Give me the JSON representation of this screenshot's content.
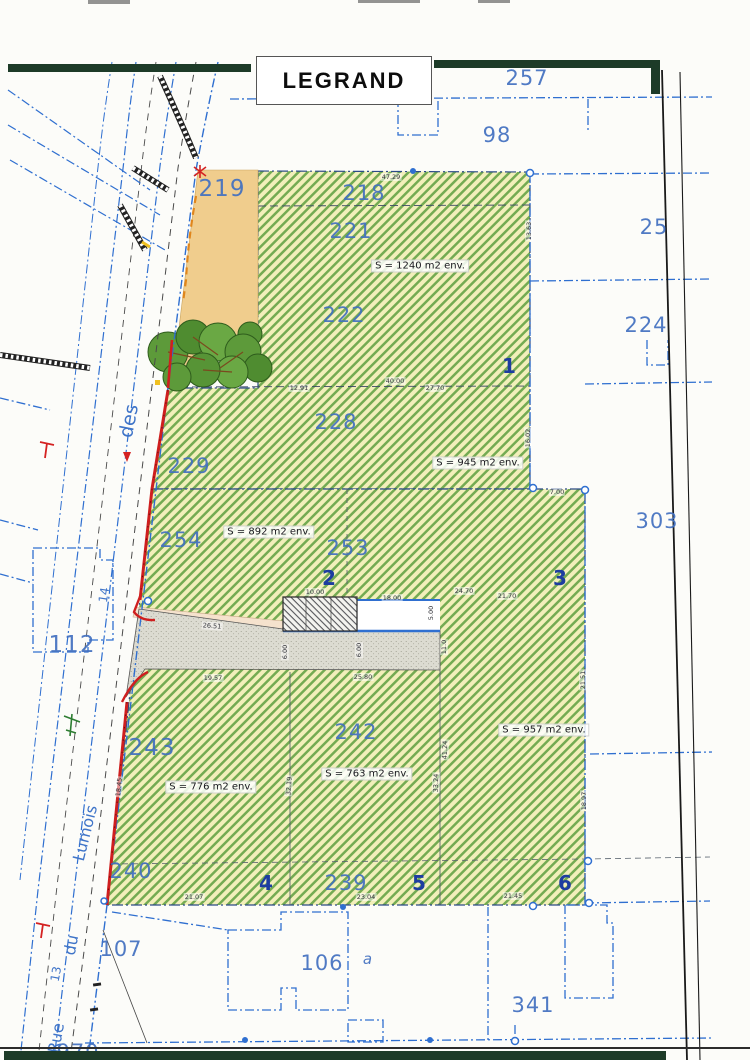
{
  "title": {
    "name": "LEGRAND"
  },
  "parcels": {
    "n257": "257",
    "n98": "98",
    "n219": "219",
    "n218": "218",
    "n221": "221",
    "n222": "222",
    "n25": "25",
    "n224": "224",
    "n228": "228",
    "n229": "229",
    "n254": "254",
    "n253": "253",
    "n303": "303",
    "n112": "112",
    "n243": "243",
    "n242": "242",
    "n240": "240",
    "n239": "239",
    "n107": "107",
    "n106": "106",
    "na": "a",
    "n341": "341",
    "n970": "970"
  },
  "lots": {
    "l1": "1",
    "l2": "2",
    "l3": "3",
    "l4": "4",
    "l5": "5",
    "l6": "6"
  },
  "surfaces": {
    "s1240": "S = 1240 m2 env.",
    "s945": "S = 945 m2 env.",
    "s892": "S = 892 m2 env.",
    "s957": "S = 957 m2 env.",
    "s776": "S = 776 m2 env.",
    "s763": "S = 763 m2 env."
  },
  "streets": {
    "rue": "Rue",
    "du": "du",
    "lumois": "Lumois",
    "des": "des",
    "w13": "13",
    "w14": "14"
  },
  "dims": {
    "d_top": "47.29",
    "d_a": "12.91",
    "d_b": "40.00",
    "d_c": "27.70",
    "d_d": "10.00",
    "d_e": "18.00",
    "d_f": "24.70",
    "d_g": "21.70",
    "d_h": "26.51",
    "d_i": "19.57",
    "d_j": "25.80",
    "d_k": "5.00",
    "d_l": "6.00",
    "d_m": "6.00",
    "d_n": "11.0",
    "d_o": "21.07",
    "d_p": "23.04",
    "d_q": "21.45",
    "d_r": "32.19",
    "d_s": "33.24",
    "d_t": "41.24",
    "d_u": "18.45",
    "d_v": "16.02",
    "d_w": "7.00",
    "d_x": "13.63",
    "d_y": "21.51",
    "d_z": "18.97"
  },
  "colors": {
    "parcel_blue": "#4270c0",
    "lot_blue": "#1d3da0",
    "boundary_blue": "#2f6fd0",
    "hatch_green": "#74ab52",
    "hatch_bg": "#f2efba",
    "boundary_red": "#cf1f1f",
    "orange_parcel": "#f0cd8d",
    "scan_bar": "#1d3b28"
  }
}
